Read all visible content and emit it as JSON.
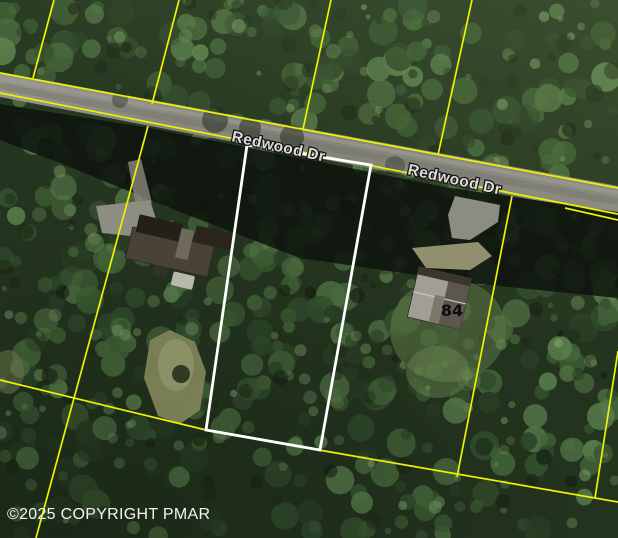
{
  "map": {
    "road_labels": [
      {
        "text": "Redwood Dr"
      },
      {
        "text": "Redwood Dr"
      }
    ],
    "parcel_labels": {
      "house_number": "84"
    },
    "copyright": "©2025 COPYRIGHT PMAR",
    "colors": {
      "boundary_yellow": "#eef103",
      "highlight_white": "#ffffff",
      "road_label_fill": "#dcdcdc",
      "house_label_fill": "#0c0c0c",
      "copyright_fill": "#f4f4f4"
    }
  }
}
